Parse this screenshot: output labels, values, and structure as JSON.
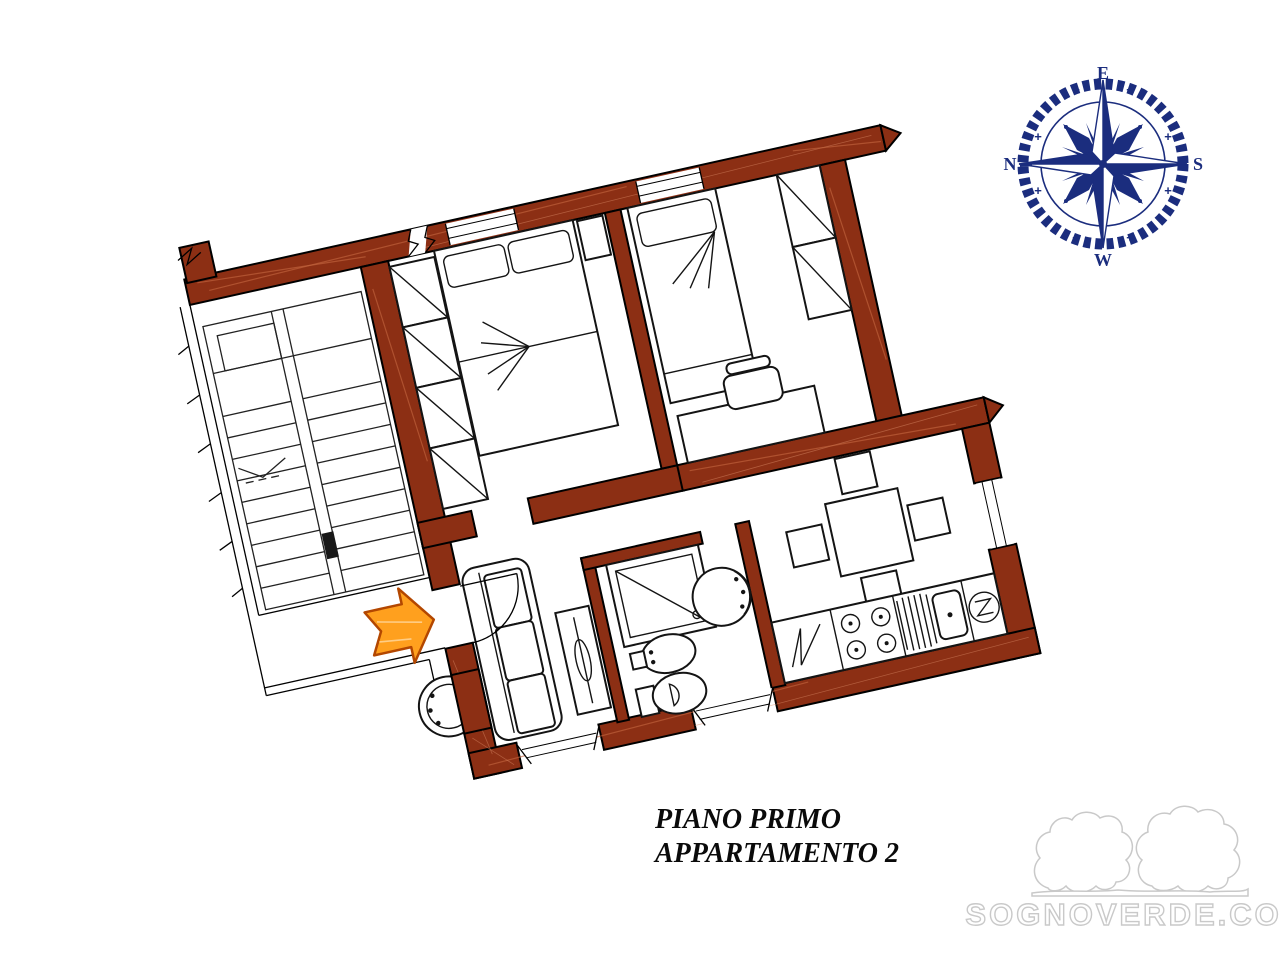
{
  "page": {
    "background": "#FFFFFF"
  },
  "plan": {
    "caption": {
      "line1": "PIANO PRIMO",
      "line2": "APPARTAMENTO 2"
    },
    "colors": {
      "wall": "#8C2F14",
      "wall_streak": "#C1643E",
      "outline": "#000000",
      "arrow_fill": "#FFA01E",
      "arrow_stroke": "#B34700"
    },
    "elements": [
      "stairs",
      "landing-basin",
      "entrance-door",
      "entrance-arrow",
      "sofa",
      "radiator",
      "double-bed",
      "nightstand",
      "wardrobe-bedroom1",
      "single-bed",
      "wardrobe-bedroom2",
      "desk",
      "desk-chair",
      "dining-table",
      "dining-chairs",
      "kitchen-counter",
      "washing-machine",
      "stove",
      "sink",
      "boiler",
      "shower",
      "bidet",
      "toilet",
      "washbasin"
    ]
  },
  "compass": {
    "labels": {
      "top": "E",
      "right": "S",
      "bottom": "W",
      "left": "N"
    },
    "color": "#1B2D7E"
  },
  "watermark": {
    "text": "SOGNOVERDE.COM",
    "color": "#C9C9C9"
  }
}
